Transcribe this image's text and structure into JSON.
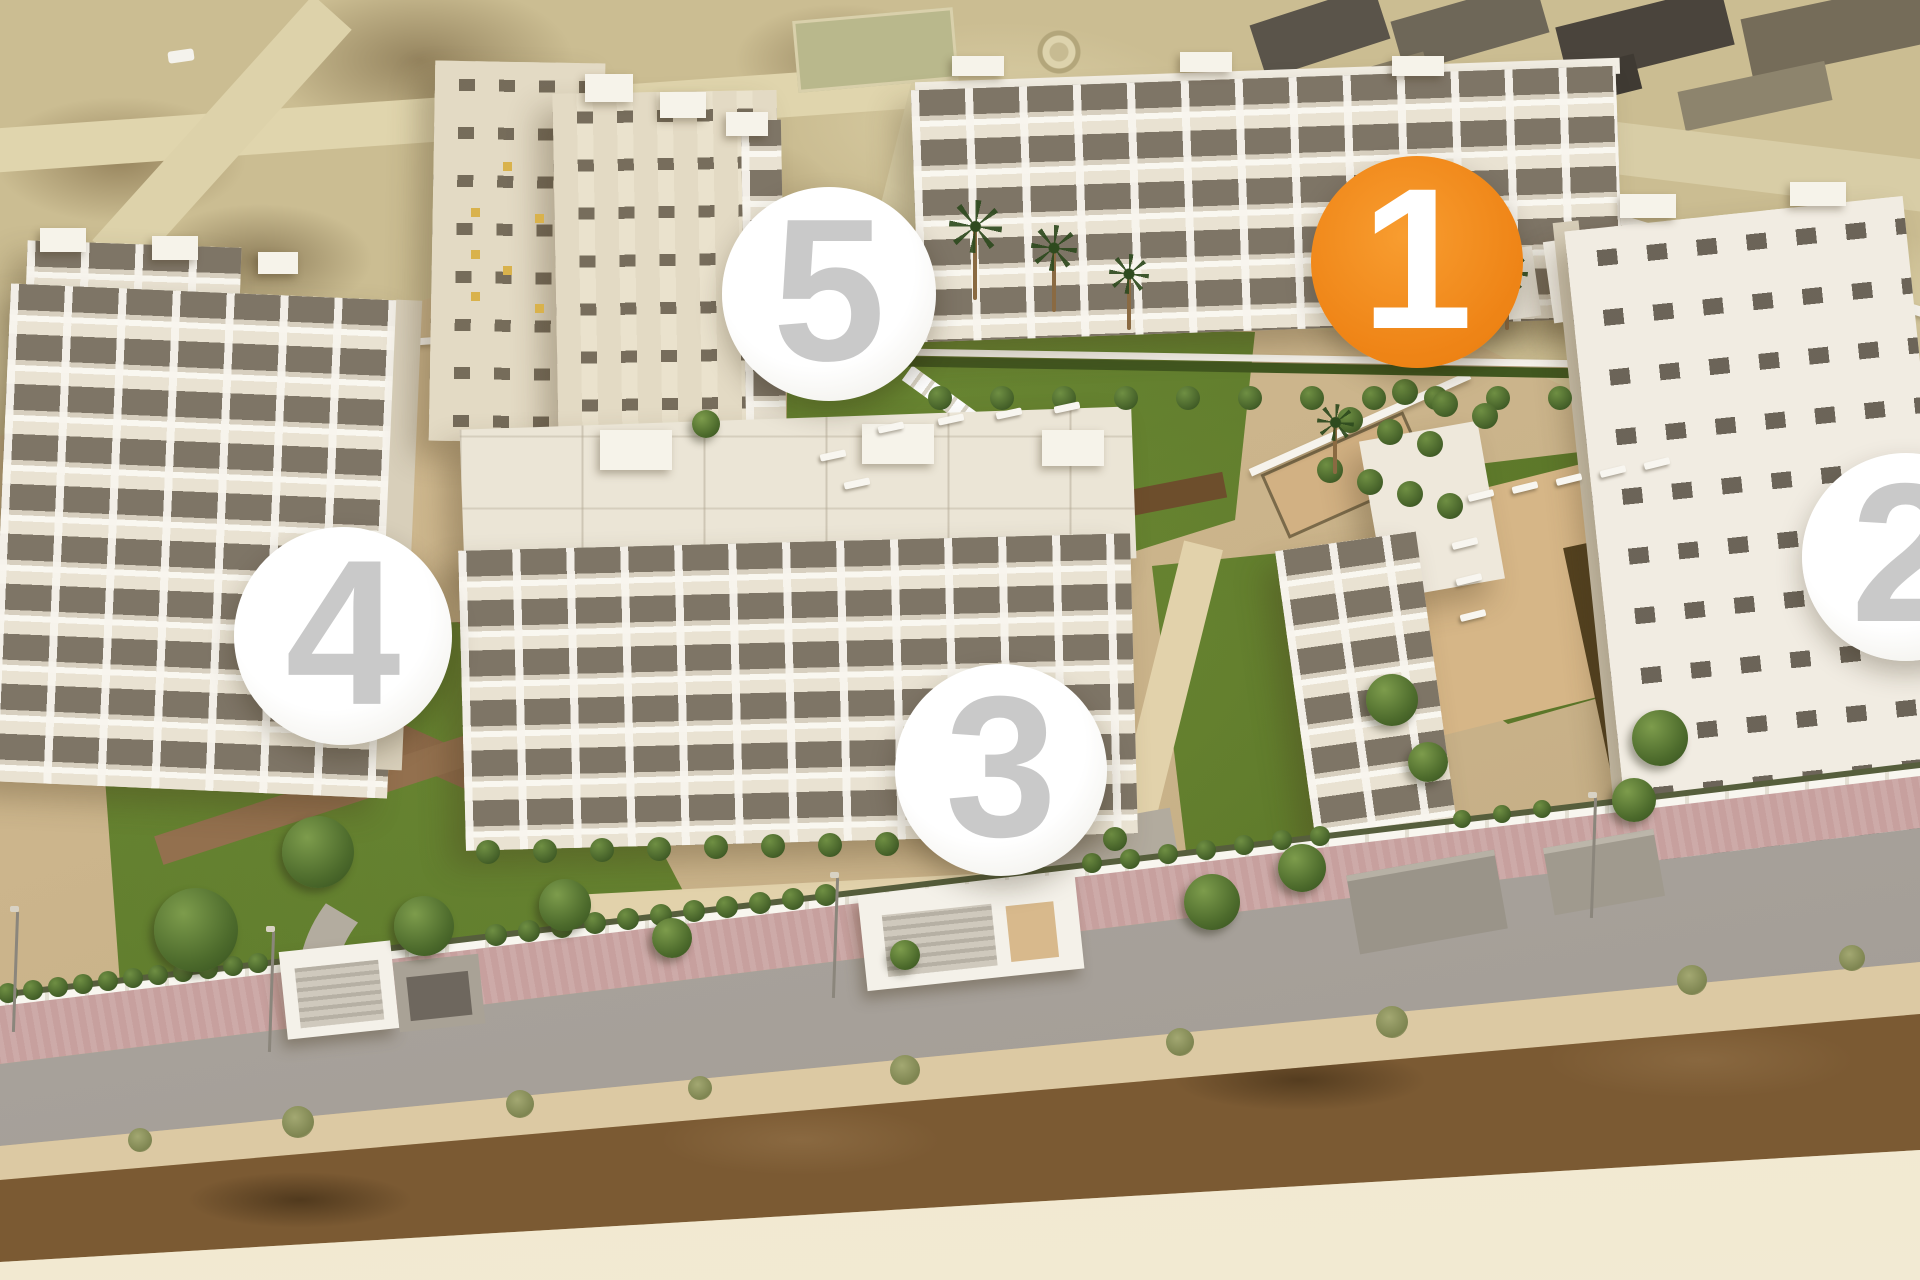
{
  "markers": {
    "items": [
      {
        "label": "1",
        "x": 1417,
        "y": 262,
        "r": 106,
        "bg": "#ef8517",
        "fg": "#ffffff",
        "highlighted": true
      },
      {
        "label": "2",
        "x": 1906,
        "y": 557,
        "r": 104,
        "bg": "#ffffff",
        "fg": "#c9c9c9",
        "highlighted": false
      },
      {
        "label": "3",
        "x": 1001,
        "y": 770,
        "r": 106,
        "bg": "#ffffff",
        "fg": "#c9c9c9",
        "highlighted": false
      },
      {
        "label": "4",
        "x": 343,
        "y": 636,
        "r": 109,
        "bg": "#ffffff",
        "fg": "#c9c9c9",
        "highlighted": false
      },
      {
        "label": "5",
        "x": 829,
        "y": 294,
        "r": 107,
        "bg": "#ffffff",
        "fg": "#c9c9c9",
        "highlighted": false
      }
    ],
    "highlight_color": "#ef8517",
    "number_color": "#c9c9c9",
    "circle_color": "#ffffff"
  }
}
